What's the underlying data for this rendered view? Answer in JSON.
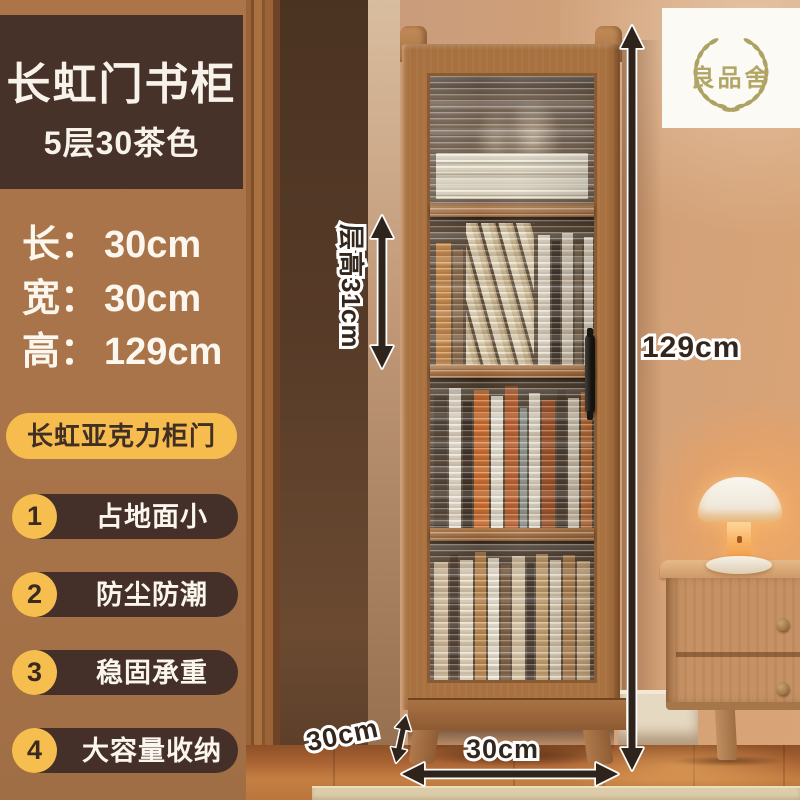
{
  "product": {
    "badge_title": "长虹门书柜",
    "badge_subtitle": "5层30茶色",
    "dimensions": [
      {
        "label": "长：",
        "value": "30cm"
      },
      {
        "label": "宽：",
        "value": "30cm"
      },
      {
        "label": "高：",
        "value": "129cm"
      }
    ],
    "feature_badge": "长虹亚克力柜门",
    "features": [
      {
        "num": "1",
        "text": "占地面小"
      },
      {
        "num": "2",
        "text": "防尘防潮"
      },
      {
        "num": "3",
        "text": "稳固承重"
      },
      {
        "num": "4",
        "text": "大容量收纳"
      }
    ]
  },
  "annotations": {
    "total_height": "129cm",
    "shelf_height": "层高31cm",
    "bottom_width": "30cm",
    "depth": "30cm"
  },
  "logo": {
    "brand": "良品舍"
  },
  "colors": {
    "panel_brown": "#a9744a",
    "badge_dark_brown": "#463229",
    "accent_yellow": "#f6bd4f",
    "pill_dark": "#443028",
    "text_white": "#faf6ee",
    "annotation_text": "#33261c",
    "logo_olive": "#aea263",
    "cabinet_wood": "#a8713f",
    "wall_beige": "#c59a7e",
    "floor_wood": "#a86233",
    "lamp_glow": "#ffaf5c"
  }
}
